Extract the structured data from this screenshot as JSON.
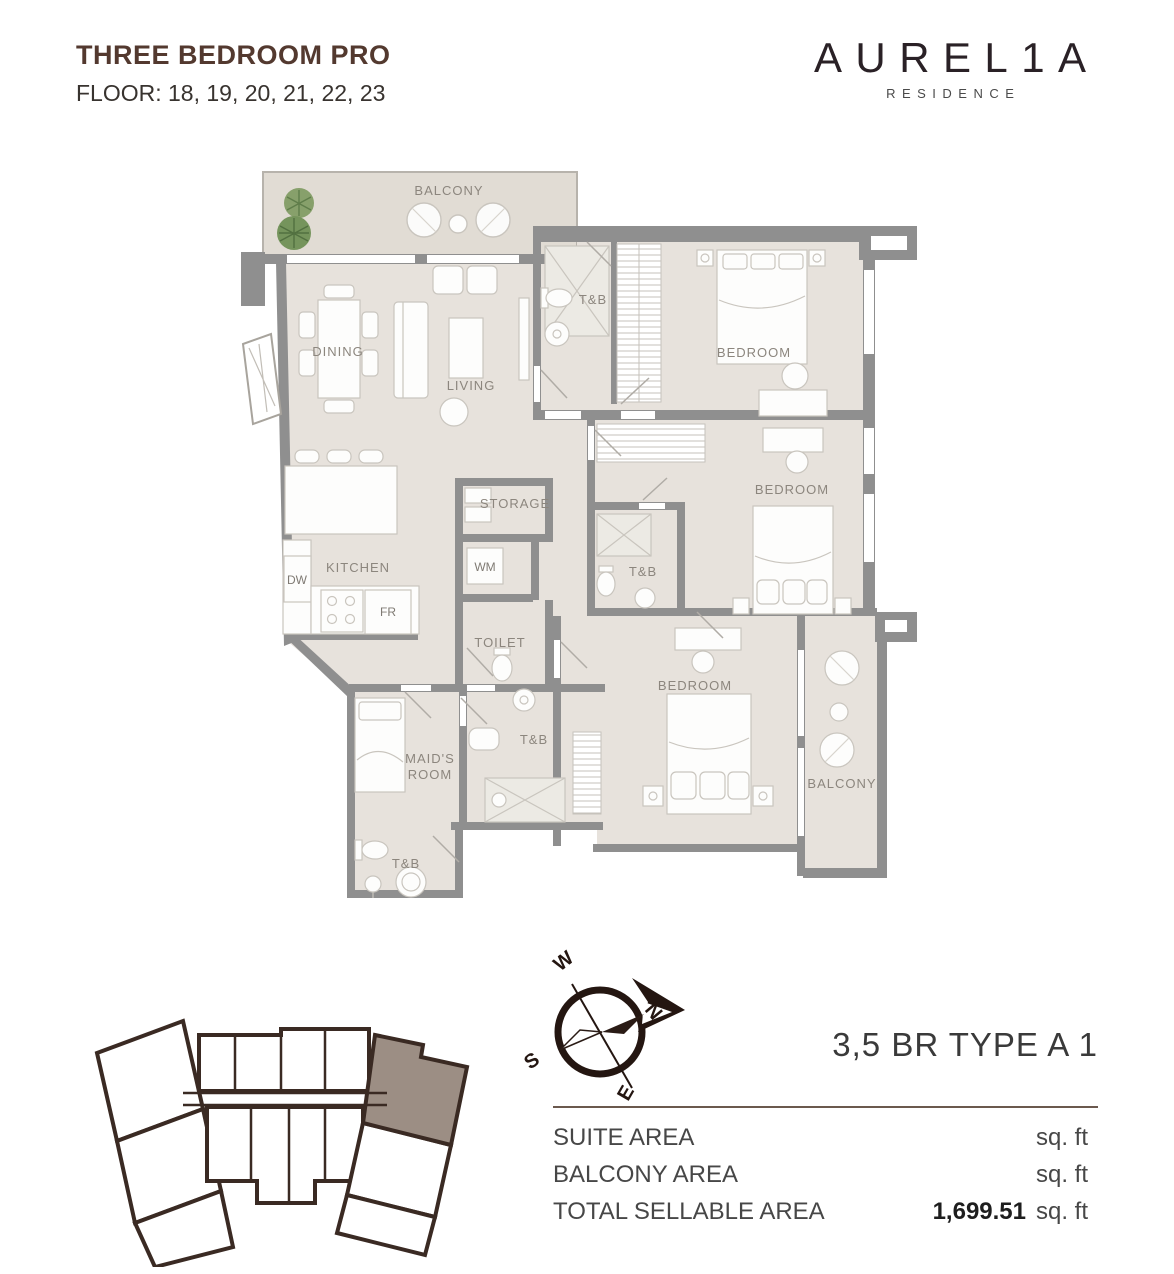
{
  "header": {
    "title": "THREE BEDROOM PRO",
    "floor_label": "FLOOR: 18, 19, 20, 21, 22, 23"
  },
  "brand": {
    "name": "AUREL1A",
    "sub": "RESIDENCE"
  },
  "floorplan": {
    "labels": {
      "balcony_top": "BALCONY",
      "tb_top": "T&B",
      "bedroom_top": "BEDROOM",
      "dining": "DINING",
      "living": "LIVING",
      "storage": "STORAGE",
      "wm": "WM",
      "kitchen": "KITCHEN",
      "dw": "DW",
      "fr": "FR",
      "toilet": "TOILET",
      "tb_mid": "T&B",
      "bedroom_mid": "BEDROOM",
      "maids_line1": "MAID'S",
      "maids_line2": "ROOM",
      "tb_inner": "T&B",
      "bedroom_bottom": "BEDROOM",
      "balcony_bottom": "BALCONY",
      "tb_bottom": "T&B"
    }
  },
  "compass": {
    "n": "N",
    "s": "S",
    "e": "E",
    "w": "W"
  },
  "unit_info": {
    "type_label": "3,5 BR TYPE A 1",
    "rows": [
      {
        "label": "SUITE AREA",
        "value": "",
        "unit": "sq. ft"
      },
      {
        "label": "BALCONY AREA",
        "value": "",
        "unit": "sq. ft"
      },
      {
        "label": "TOTAL SELLABLE AREA",
        "value": "1,699.51",
        "unit": "sq. ft"
      }
    ]
  },
  "colors": {
    "title_brown": "#53392f",
    "plan_wall": "#8f8f8f",
    "plan_floor": "#e7e2dc",
    "keyplan_outline": "#3a2a23",
    "keyplan_highlight": "#9c8e84",
    "rule_brown": "#6b594e"
  }
}
